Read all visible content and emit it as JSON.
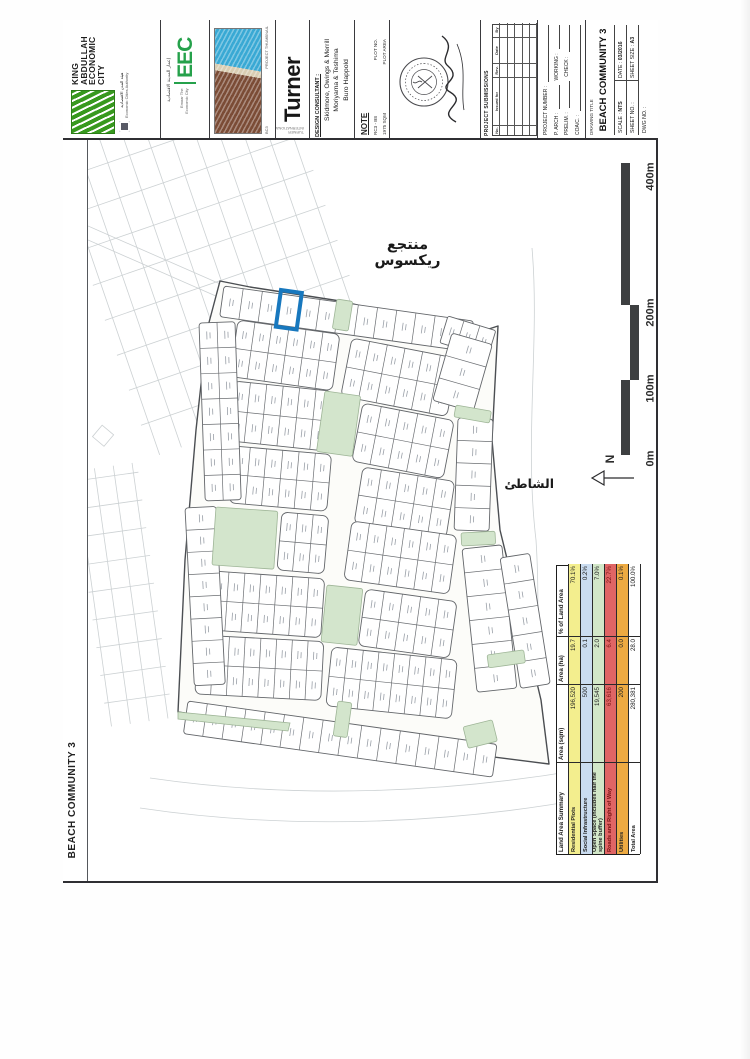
{
  "side_label": "BEACH COMMUNITY 3",
  "title_block": {
    "kaec": {
      "name_lines": [
        "KING",
        "ABDULLAH",
        "ECONOMIC",
        "CITY"
      ],
      "authority_ar": "هيئة المدن الاقتصادية",
      "authority_en": "Economic Cities Authority"
    },
    "eec": {
      "logo_text": "EEC",
      "ar": "إعمار المدينة الاقتصادية",
      "en": "Emaar The Economic City"
    },
    "thumbnail": {
      "label": "PROJECT THUMBNAIL",
      "code": "BC3"
    },
    "turner": {
      "logo_text": "Turner",
      "sub": "TURNER INTERNATIONAL"
    },
    "consultant": {
      "heading": "DESIGN CONSULTANT :",
      "lines": [
        "Skidmore, Owings & Merrill",
        "Moriyama & Teshima",
        "Buro Happold"
      ]
    },
    "note": {
      "heading": "NOTE",
      "rows": [
        [
          "RC3 - B8",
          "PLOT NO."
        ],
        [
          "1975 SQM",
          "PLOT AREA"
        ]
      ]
    },
    "submissions": {
      "heading": "PROJECT SUBMISSIONS",
      "columns": [
        "No.",
        "Issued for",
        "Rev.",
        "Date",
        "By"
      ],
      "row_count": 5
    },
    "management": {
      "fields": [
        [
          "PROJECT NUMBER :",
          ""
        ],
        [
          "P. ARCH :",
          "WORKING :"
        ],
        [
          "PRELIM. :",
          "CHECK :"
        ],
        [
          "COA/C. :",
          ""
        ]
      ]
    },
    "title": {
      "drawing_title_label": "DRAWING TITLE",
      "drawing_title": "BEACH COMMUNITY 3",
      "scale_label": "SCALE :",
      "scale": "NTS",
      "date_label": "DATE :",
      "date": "03/2016",
      "sheet_no_label": "SHEET NO. :",
      "sheet_size_label": "SHEET SIZE :",
      "sheet_size": "A3",
      "dwg_label": "DWG NO. :"
    }
  },
  "map": {
    "resort_label_ar": "منتجع ريكسوس",
    "beach_label_ar": "الشاطئ",
    "north_label": "N",
    "scale_labels": [
      "0m",
      "100m",
      "200m",
      "400m"
    ],
    "highlight_color": "#1878be",
    "open_space_color": "#d3e5cc"
  },
  "land_area_table": {
    "headers": [
      "Land Area Summary",
      "Area (sqm)",
      "Area (ha)",
      "% of Land Area"
    ],
    "rows": [
      {
        "label": "Residential Plots",
        "sqm": "196,520",
        "ha": "19.7",
        "pct": "70.1%",
        "color": "#f3ee8e",
        "text": "#222222"
      },
      {
        "label": "Social Infrastructure",
        "sqm": "500",
        "ha": "0.1",
        "pct": "0.2%",
        "color": "#cadcf0",
        "text": "#222222"
      },
      {
        "label": "Open Space (includes half the spine buffer)",
        "sqm": "19,545",
        "ha": "2.0",
        "pct": "7.0%",
        "color": "#d2e7c8",
        "text": "#222222"
      },
      {
        "label": "Roads and Right of Way",
        "sqm": "63,616",
        "ha": "6.4",
        "pct": "22.7%",
        "color": "#e06565",
        "text": "#7a1616"
      },
      {
        "label": "Utilities",
        "sqm": "200",
        "ha": "0.0",
        "pct": "0.1%",
        "color": "#edaa42",
        "text": "#222222"
      },
      {
        "label": "Total Area",
        "sqm": "280,381",
        "ha": "28.0",
        "pct": "100.0%",
        "color": "#ffffff",
        "text": "#222222"
      }
    ]
  }
}
